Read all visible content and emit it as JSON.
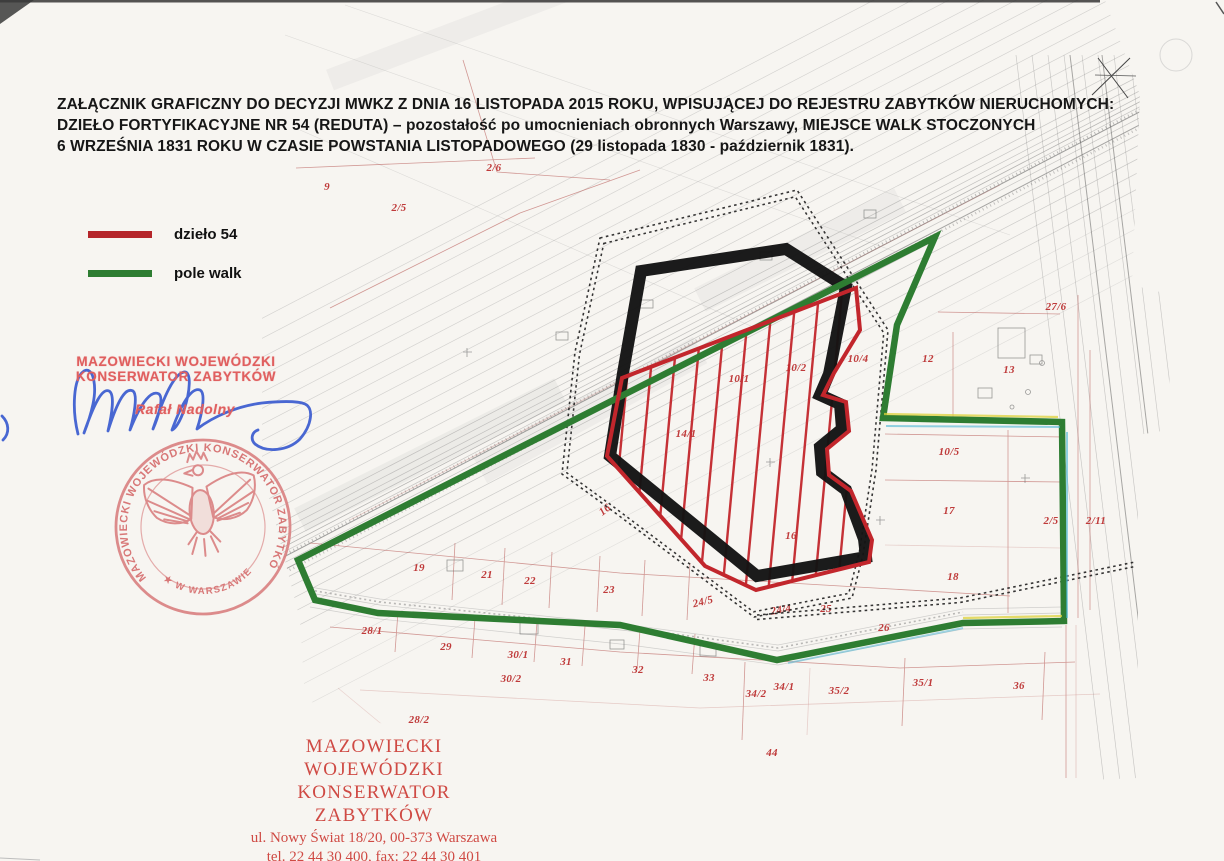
{
  "document": {
    "title_lines": [
      "ZAŁĄCZNIK GRAFICZNY DO DECYZJI MWKZ Z DNIA 16 LISTOPADA 2015 ROKU, WPISUJĄCEJ DO REJESTRU ZABYTKÓW NIERUCHOMYCH:",
      "DZIEŁO FORTYFIKACYJNE NR 54 (REDUTA) – pozostałość po umocnieniach obronnych Warszawy, MIEJSCE WALK STOCZONYCH",
      "6 WRZEŚNIA 1831 ROKU W CZASIE POWSTANIA LISTOPADOWEGO (29 listopada 1830 - październik 1831)."
    ]
  },
  "legend": {
    "items": [
      {
        "label": "dzieło 54",
        "color": "#b5252a"
      },
      {
        "label": "pole walk",
        "color": "#2e7d32"
      }
    ]
  },
  "approval": {
    "stamp_line1": "MAZOWIECKI WOJEWÓDZKI",
    "stamp_line2": "KONSERWATOR ZABYTKÓW",
    "signer": "Rafał Nadolny"
  },
  "seal": {
    "ring_text": "MAZOWIECKI WOJEWÓDZKI KONSERWATOR ZABYTKÓW",
    "bottom_text": "★ W WARSZAWIE ★"
  },
  "footer": {
    "org_line1": "MAZOWIECKI WOJEWÓDZKI",
    "org_line2": "KONSERWATOR ZABYTKÓW",
    "address": "ul. Nowy Świat 18/20, 00-373 Warszawa",
    "phones": "tel. 22 44 30 400, fax: 22 44 30 401",
    "website": "www.mwkz.pl",
    "page_number": "-1-"
  },
  "map": {
    "colors": {
      "boundary_red": "#c2262c",
      "boundary_green": "#2e7d32",
      "fort_black": "#141414",
      "parcel_label_red": "#bf3a3a",
      "stamp_red": "#e05f5f",
      "seal_red": "#d98080",
      "footer_red": "#cf4a44",
      "signature_blue": "#3f5fd0"
    },
    "labels": [
      {
        "t": "2/6",
        "x": 494,
        "y": 168
      },
      {
        "t": "9",
        "x": 327,
        "y": 187
      },
      {
        "t": "2/5",
        "x": 399,
        "y": 208
      },
      {
        "t": "27/6",
        "x": 1056,
        "y": 307
      },
      {
        "t": "12",
        "x": 928,
        "y": 359
      },
      {
        "t": "13",
        "x": 1009,
        "y": 370
      },
      {
        "t": "10/4",
        "x": 858,
        "y": 359
      },
      {
        "t": "10/2",
        "x": 796,
        "y": 368
      },
      {
        "t": "10/1",
        "x": 739,
        "y": 379
      },
      {
        "t": "14/1",
        "x": 686,
        "y": 434
      },
      {
        "t": "10/5",
        "x": 949,
        "y": 452
      },
      {
        "t": "17",
        "x": 949,
        "y": 511
      },
      {
        "t": "16",
        "x": 605,
        "y": 510,
        "rot": -38
      },
      {
        "t": "16",
        "x": 791,
        "y": 536
      },
      {
        "t": "18",
        "x": 953,
        "y": 577
      },
      {
        "t": "19",
        "x": 419,
        "y": 568
      },
      {
        "t": "21",
        "x": 487,
        "y": 575
      },
      {
        "t": "22",
        "x": 530,
        "y": 581
      },
      {
        "t": "23",
        "x": 609,
        "y": 590
      },
      {
        "t": "24/5",
        "x": 703,
        "y": 602,
        "rot": -14
      },
      {
        "t": "24/4",
        "x": 781,
        "y": 610,
        "rot": -10
      },
      {
        "t": "25",
        "x": 826,
        "y": 609
      },
      {
        "t": "26",
        "x": 884,
        "y": 628
      },
      {
        "t": "2/5",
        "x": 1051,
        "y": 521
      },
      {
        "t": "2/11",
        "x": 1096,
        "y": 521
      },
      {
        "t": "28/1",
        "x": 372,
        "y": 631
      },
      {
        "t": "29",
        "x": 446,
        "y": 647
      },
      {
        "t": "30/1",
        "x": 518,
        "y": 655
      },
      {
        "t": "31",
        "x": 566,
        "y": 662
      },
      {
        "t": "30/2",
        "x": 511,
        "y": 679
      },
      {
        "t": "32",
        "x": 638,
        "y": 670
      },
      {
        "t": "33",
        "x": 709,
        "y": 678
      },
      {
        "t": "34/2",
        "x": 756,
        "y": 694
      },
      {
        "t": "34/1",
        "x": 784,
        "y": 687
      },
      {
        "t": "35/2",
        "x": 839,
        "y": 691
      },
      {
        "t": "35/1",
        "x": 923,
        "y": 683
      },
      {
        "t": "36",
        "x": 1019,
        "y": 686
      },
      {
        "t": "28/2",
        "x": 419,
        "y": 720
      },
      {
        "t": "44",
        "x": 772,
        "y": 753
      }
    ]
  }
}
